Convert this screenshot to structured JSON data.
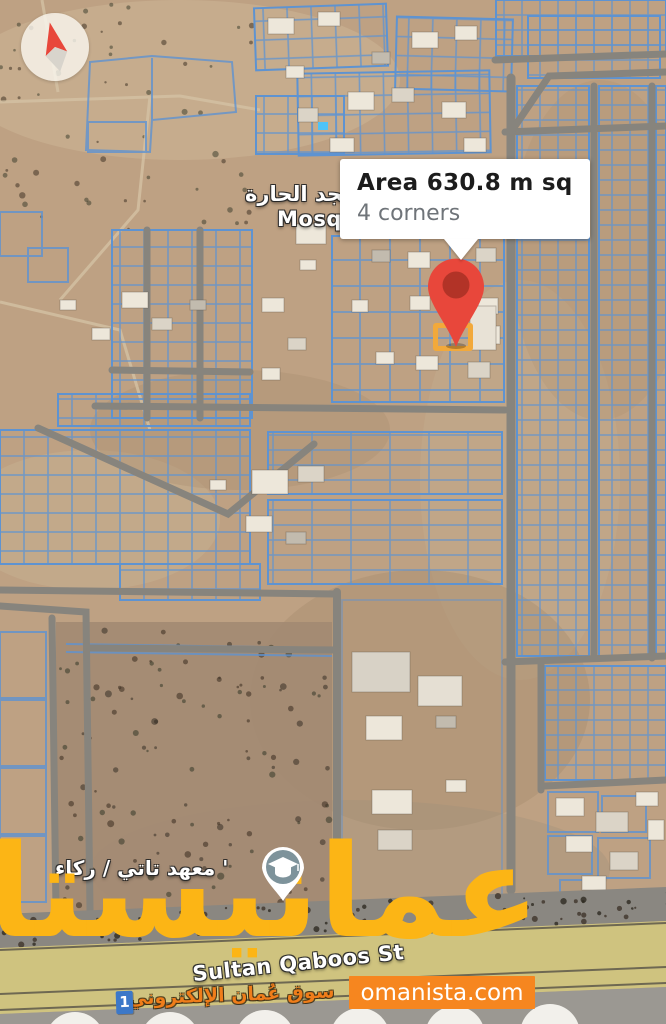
{
  "map": {
    "callout": {
      "title": "Area 630.8 m sq",
      "subtitle": "4 corners"
    },
    "labels": {
      "mosque_ar": "مسجد الحارة",
      "mosque_en": "Mosque",
      "institute_ar": "' معهد تاتي / ركاء",
      "street": "Sultan Qaboos St"
    }
  },
  "watermark": {
    "brand_ar": "عمانيستا",
    "tagline_ar": "سوق عُمان الإلكتروني",
    "site": "omanista.com",
    "route_badge": "1"
  },
  "colors": {
    "pin-red": "#E8473B",
    "pin-red-dark": "#B23327",
    "parcel-highlight": "#F2A93B",
    "parcel-blue": "#5E93D1",
    "brand-yellow": "#FCB515",
    "banner-orange": "#F6861F",
    "tagline-orange": "#EF7D1A",
    "badge-blue": "#3C78C8",
    "school-teal": "#7E939B",
    "callout-bg": "#FFFFFF",
    "callout-title": "#1C1C1C",
    "callout-subtitle": "#6F7479"
  }
}
